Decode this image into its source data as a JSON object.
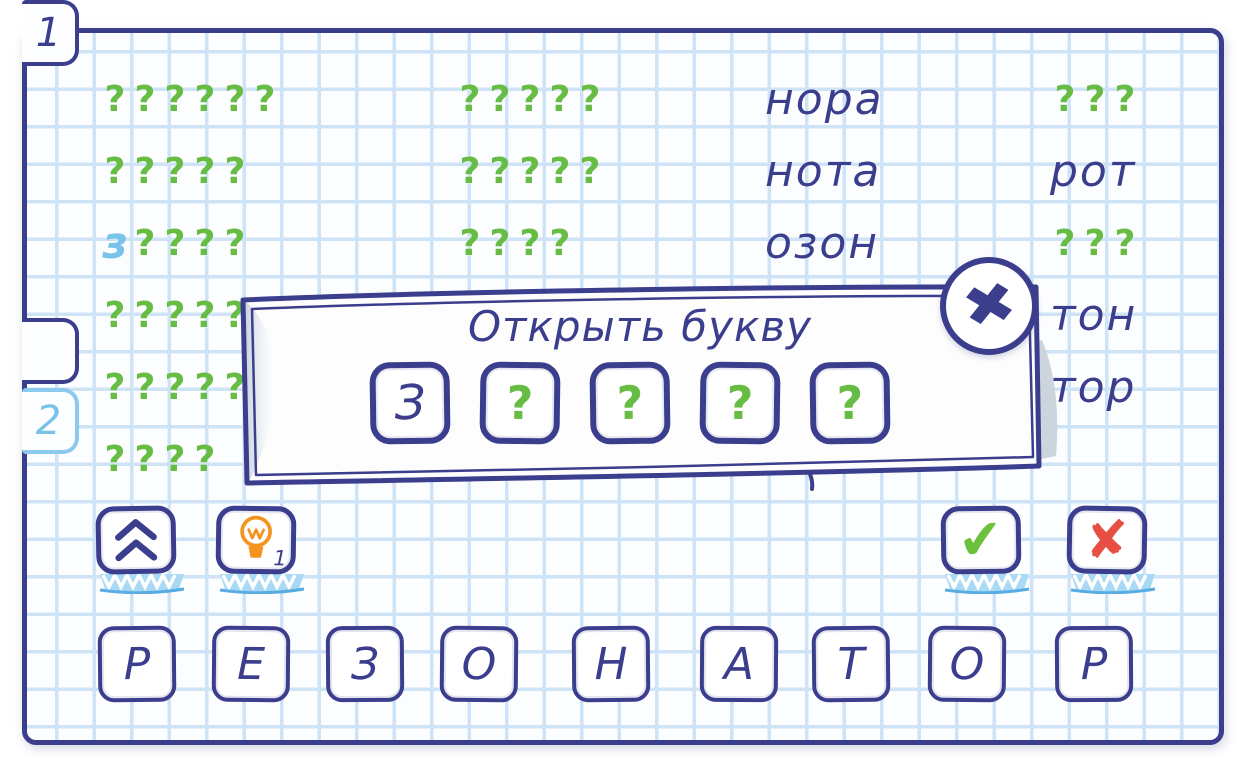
{
  "colors": {
    "ink": "#3b3d8d",
    "green": "#67bc44",
    "hint_blue": "#79c2ea",
    "orange": "#f39421",
    "red": "#e84f44",
    "check_green": "#6cc13c",
    "grid_line": "#cfe3f6",
    "paper": "#fcfdff",
    "shadow_band": "#a8d9f5",
    "shadow_edge": "#59ace2",
    "curl_gray": "#ccd5de"
  },
  "tabs": [
    {
      "label": "1",
      "active": true
    },
    {
      "label": "2",
      "active": false
    }
  ],
  "board": {
    "mask_char": "?",
    "columns": [
      {
        "x": 100,
        "rows": [
          {
            "type": "masked",
            "length": 6
          },
          {
            "type": "masked",
            "length": 5
          },
          {
            "type": "masked",
            "length": 4,
            "revealed_prefix": "з"
          },
          {
            "type": "masked",
            "length": 5
          },
          {
            "type": "masked",
            "length": 5
          },
          {
            "type": "masked",
            "length": 4
          }
        ]
      },
      {
        "x": 455,
        "rows": [
          {
            "type": "masked",
            "length": 5
          },
          {
            "type": "masked",
            "length": 5
          },
          {
            "type": "masked",
            "length": 4
          }
        ]
      },
      {
        "x": 765,
        "rows": [
          {
            "type": "solved",
            "word": "нора"
          },
          {
            "type": "solved",
            "word": "нота"
          },
          {
            "type": "solved",
            "word": "озон"
          }
        ]
      },
      {
        "x": 1050,
        "rows": [
          {
            "type": "masked",
            "length": 3
          },
          {
            "type": "solved",
            "word": "рот"
          },
          {
            "type": "masked",
            "length": 3
          },
          {
            "type": "solved",
            "word": "тон"
          },
          {
            "type": "solved",
            "word": "тор"
          }
        ]
      }
    ]
  },
  "dialog": {
    "title": "Открыть букву",
    "tiles": [
      {
        "type": "letter",
        "value": "З"
      },
      {
        "type": "mask",
        "value": "?"
      },
      {
        "type": "mask",
        "value": "?"
      },
      {
        "type": "mask",
        "value": "?"
      },
      {
        "type": "mask",
        "value": "?"
      }
    ],
    "close_icon": "✖"
  },
  "controls": {
    "hint_count": "1",
    "check_icon": "✔",
    "cancel_icon": "✘"
  },
  "keyboard": {
    "letters": [
      "Р",
      "Е",
      "З",
      "О",
      "Н",
      "А",
      "Т",
      "О",
      "Р"
    ]
  }
}
